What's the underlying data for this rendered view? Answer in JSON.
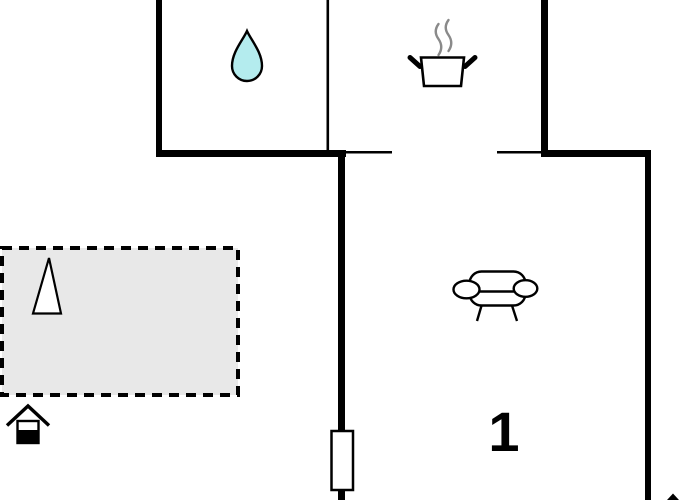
{
  "plan": {
    "type": "floor-plan",
    "unit_label": "1",
    "icons": [
      {
        "name": "water-drop-icon",
        "meaning": "bathroom"
      },
      {
        "name": "cooking-pot-icon",
        "meaning": "kitchen"
      },
      {
        "name": "sofa-icon",
        "meaning": "living-room"
      },
      {
        "name": "tree-icon",
        "meaning": "terrace-planting"
      },
      {
        "name": "entrance-house-icon",
        "meaning": "entrance"
      },
      {
        "name": "door-symbol",
        "meaning": "door-in-wall"
      }
    ]
  },
  "colors": {
    "wall": "#000000",
    "terrace_fill": "#e8e8e8",
    "water_drop_fill": "#b4ecee",
    "steam": "#8a8a8a",
    "bg": "#ffffff"
  }
}
